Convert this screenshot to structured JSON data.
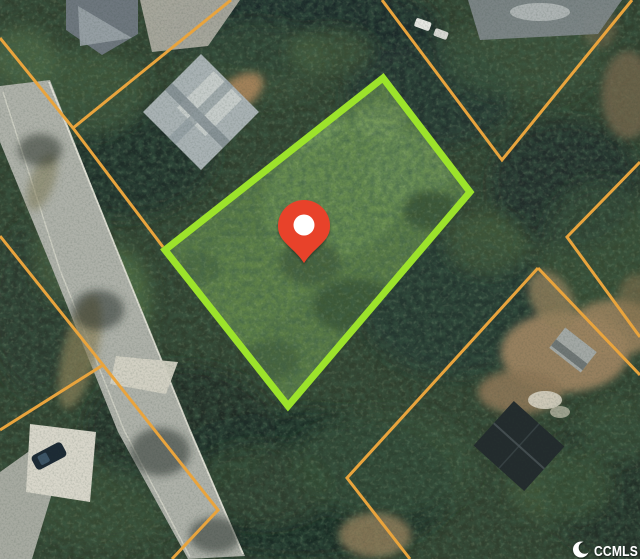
{
  "watermark": {
    "label": "CCMLS",
    "icon": "crescent-c-logo-icon",
    "text_color": "#FFFFFF"
  },
  "marker": {
    "icon": "location-pin-icon"
  },
  "colors": {
    "highlight_boundary": "#9CE32B",
    "parcel_lines": "#E9A43D",
    "pin": "#E8432C",
    "pin_dot": "#FFFFFF"
  }
}
